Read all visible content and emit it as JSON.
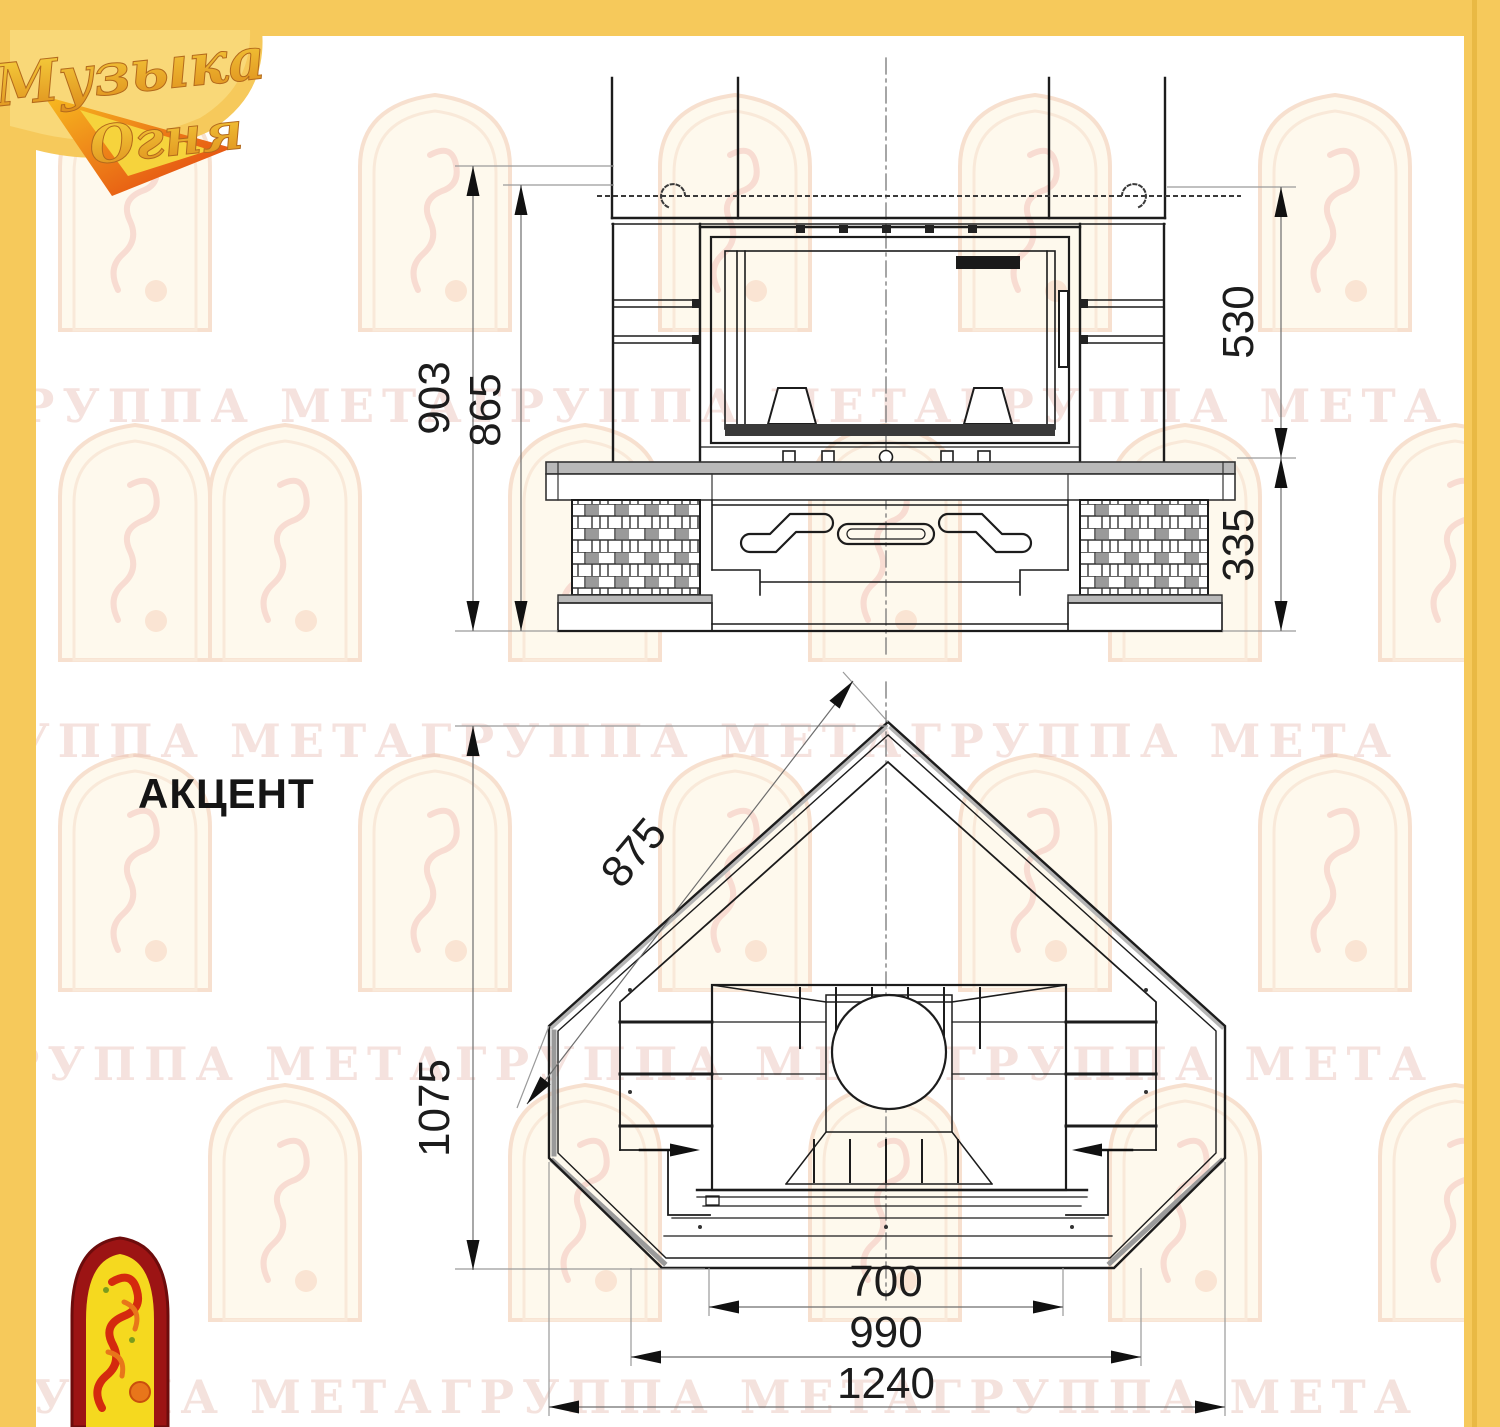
{
  "watermark": {
    "text": "ГРУППА МЕТАГРУППА МЕТАГРУППА МЕТА"
  },
  "logo": {
    "line1": "Музыка",
    "line2": "Огня"
  },
  "model": {
    "name": "АКЦЕНТ"
  },
  "front_view": {
    "height_overall": "903",
    "height_firebox": "865",
    "upper_zone": "530",
    "base_height": "335"
  },
  "plan_view": {
    "side_length": "875",
    "depth": "1075",
    "opening_width": "700",
    "inner_width": "990",
    "overall_width": "1240"
  },
  "colors": {
    "frame": "#F6C95B",
    "line": "#1c1c1c",
    "dim_line": "#7a7a7a",
    "watermark": "#e7bbb0"
  }
}
